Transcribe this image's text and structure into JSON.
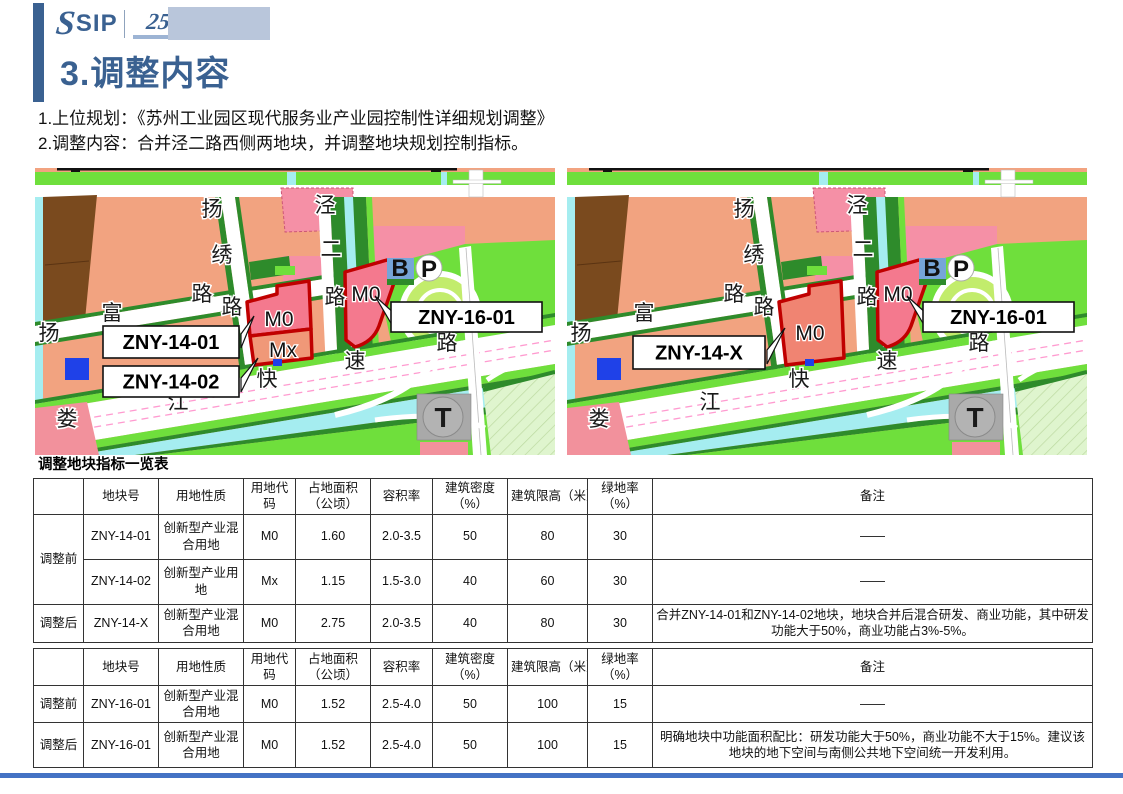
{
  "header": {
    "logo_mark": "S",
    "logo_name": "SIP",
    "logo_anniversary": "25",
    "title": "3.调整内容"
  },
  "intro": {
    "line1": "1.上位规划：《苏州工业园区现代服务业产业园控制性详细规划调整》",
    "line2": "2.调整内容：合并泾二路西侧两地块，并调整地块规划控制指标。"
  },
  "map": {
    "roads": [
      "扬绣路",
      "泾二路",
      "扬富路",
      "娄江快速路"
    ],
    "markers": {
      "bus": "B",
      "parking": "P",
      "metro": "T"
    },
    "left": {
      "plot_codes": [
        "M0",
        "Mx",
        "M0"
      ],
      "callouts": [
        "ZNY-14-01",
        "ZNY-14-02",
        "ZNY-16-01"
      ]
    },
    "right": {
      "plot_codes": [
        "M0",
        "M0"
      ],
      "callouts": [
        "ZNY-14-X",
        "ZNY-16-01"
      ]
    }
  },
  "section_title": "调整地块指标一览表",
  "tables": [
    {
      "headers": [
        "",
        "地块号",
        "用地性质",
        "用地代码",
        "占地面积（公顷）",
        "容积率",
        "建筑密度（%）",
        "建筑限高（米）",
        "绿地率（%）",
        "备注"
      ],
      "rows": [
        {
          "stage": "调整前",
          "stage_span": 2,
          "plot": "ZNY-14-01",
          "use": "创新型产业混合用地",
          "code": "M0",
          "area": "1.60",
          "far": "2.0-3.5",
          "density": "50",
          "height": "80",
          "green": "30",
          "remark": "——"
        },
        {
          "stage": null,
          "plot": "ZNY-14-02",
          "use": "创新型产业用地",
          "code": "Mx",
          "area": "1.15",
          "far": "1.5-3.0",
          "density": "40",
          "height": "60",
          "green": "30",
          "remark": "——"
        },
        {
          "stage": "调整后",
          "stage_span": 1,
          "plot": "ZNY-14-X",
          "use": "创新型产业混合用地",
          "code": "M0",
          "area": "2.75",
          "far": "2.0-3.5",
          "density": "40",
          "height": "80",
          "green": "30",
          "remark": "合并ZNY-14-01和ZNY-14-02地块，地块合并后混合研发、商业功能，其中研发功能大于50%，商业功能占3%-5%。"
        }
      ]
    },
    {
      "headers": [
        "",
        "地块号",
        "用地性质",
        "用地代码",
        "占地面积（公顷）",
        "容积率",
        "建筑密度（%）",
        "建筑限高（米）",
        "绿地率（%）",
        "备注"
      ],
      "rows": [
        {
          "stage": "调整前",
          "stage_span": 1,
          "plot": "ZNY-16-01",
          "use": "创新型产业混合用地",
          "code": "M0",
          "area": "1.52",
          "far": "2.5-4.0",
          "density": "50",
          "height": "100",
          "green": "15",
          "remark": "——"
        },
        {
          "stage": "调整后",
          "stage_span": 1,
          "plot": "ZNY-16-01",
          "use": "创新型产业混合用地",
          "code": "M0",
          "area": "1.52",
          "far": "2.5-4.0",
          "density": "50",
          "height": "100",
          "green": "15",
          "remark": "明确地块中功能面积配比：研发功能大于50%，商业功能不大于15%。建议该地块的地下空间与南侧公共地下空间统一开发利用。"
        }
      ]
    }
  ],
  "colors": {
    "title_blue": "#3A6191",
    "bottom_bar_blue": "#4472C4",
    "plot_outline_red": "#C00000",
    "plot_pink": "#F4798E",
    "plot_salmon": "#F09878",
    "plot_coral": "#F08472",
    "land_salmon": "#F2A380",
    "zone_pink": "#F590A6",
    "water_cyan": "#A5EDF0",
    "green_dark": "#2E8B2B",
    "green_bright": "#6FDF3C",
    "green_light": "#C2EC6C",
    "brown": "#7A4A1E",
    "parcel_blue": "#1F41E8",
    "bus_blue": "#76A5D8"
  }
}
